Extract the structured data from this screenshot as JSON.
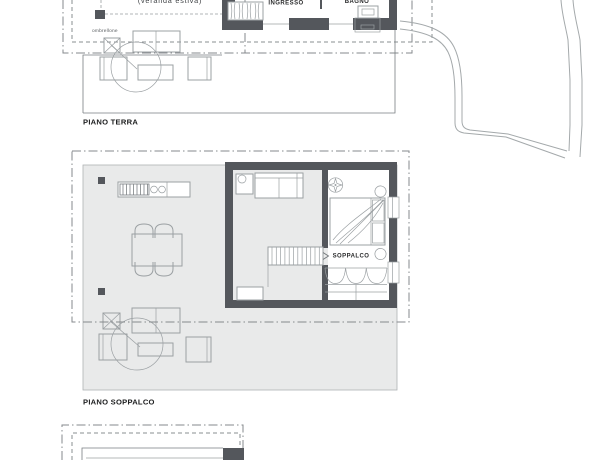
{
  "canvas": {
    "width": 600,
    "height": 460,
    "background": "#ffffff"
  },
  "colors": {
    "wall": "#54575c",
    "floor": "#e9eaea",
    "furniture_line": "#9ba0a3",
    "boundary_line": "#85898c",
    "title_text": "#1c1d1e",
    "muted_text": "#595d60"
  },
  "plan_terra": {
    "title": "PIANO TERRA",
    "room_ingresso": "INGRESSO",
    "room_bagno": "BAGNO",
    "label_ombrellone": "ombrellone",
    "label_veranda": "(veranda estiva)"
  },
  "plan_soppalco": {
    "title": "PIANO SOPPALCO",
    "room_soppalco": "SOPPALCO"
  }
}
